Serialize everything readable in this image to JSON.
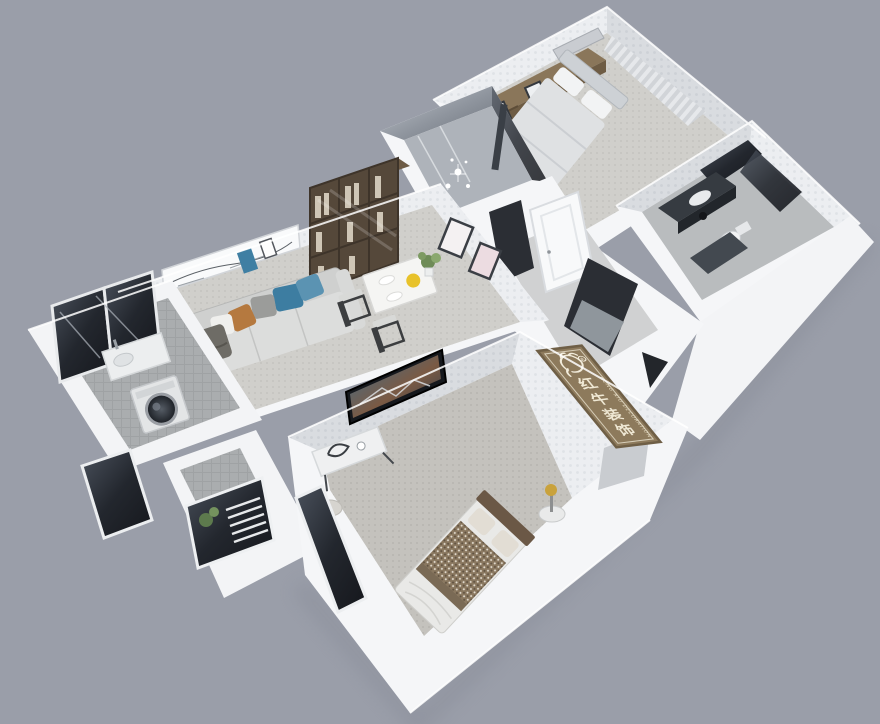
{
  "scene": {
    "type": "3d-floorplan-cutaway-render",
    "background_color": "#9a9ea9",
    "wall_color": "#f5f6f8",
    "rooms": [
      "living-dining-room",
      "master-bedroom-top",
      "shower-room",
      "bathroom",
      "hallway-entrance",
      "laundry-balcony",
      "small-balcony",
      "bedroom-bottom"
    ],
    "furniture": [
      "sofa",
      "bookshelf",
      "dining-table",
      "dining-chairs",
      "wall-art-panel",
      "wardrobe",
      "double-bed-top",
      "curtains",
      "vanity",
      "toilet",
      "mirror",
      "washing-machine",
      "laundry-counter",
      "tv-panel",
      "console-desk",
      "double-bed-bottom",
      "nightstand-lamp",
      "entry-cabinet",
      "ac-unit"
    ]
  },
  "watermark": {
    "logo": "bull-logo",
    "text_cn": "红牛装饰",
    "chars": [
      "红",
      "牛",
      "装",
      "饰"
    ],
    "text_en": "HONG NIU DECORATION"
  },
  "palette": {
    "background": "#9a9ea9",
    "wall_white": "#f7f8fa",
    "wall_texture": "#e9ebee",
    "carpet_light": "#d0cfcb",
    "carpet_dark": "#c3c1bc",
    "balcony_tile": "#a9acae",
    "glass_dark": "#1b1e24",
    "wood_bookshelf": "#55483a",
    "wood_wardrobe": "#8a765a",
    "plaque_wood": "#8d7a5c",
    "pillow_blue": "#3d7da1",
    "pillow_orange": "#b5793f",
    "bowl_yellow": "#e8c22a"
  }
}
